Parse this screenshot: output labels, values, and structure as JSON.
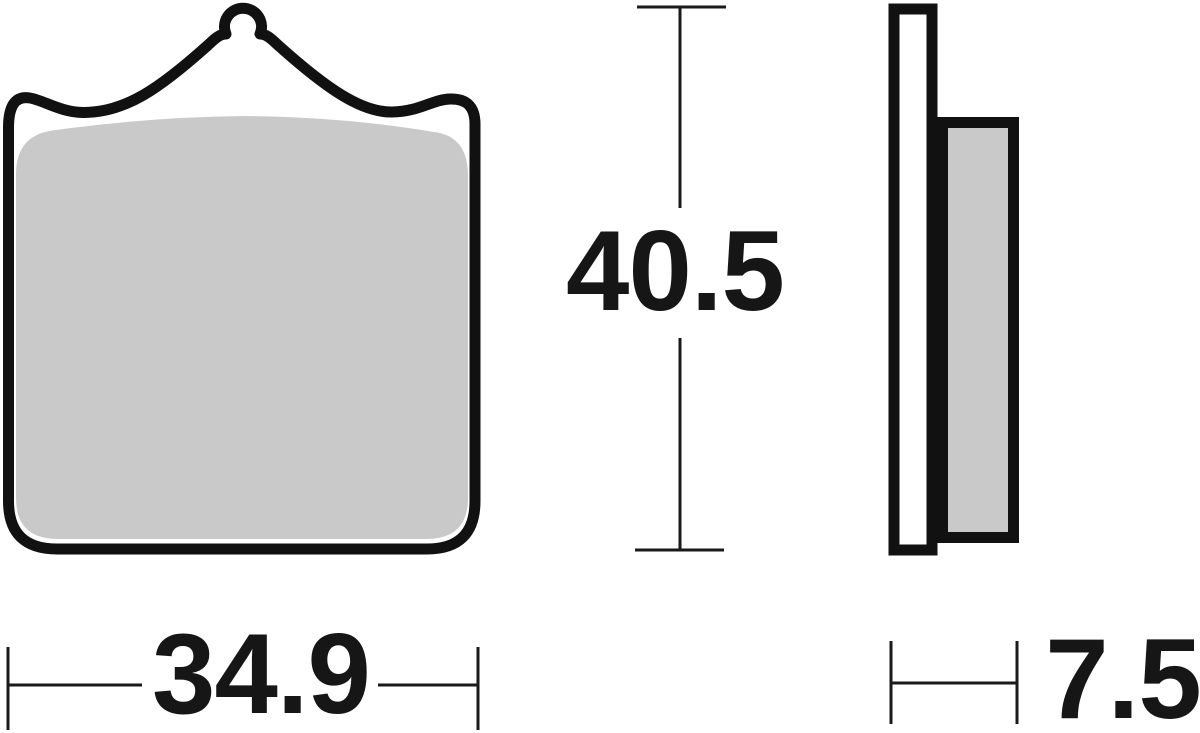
{
  "figure": {
    "type": "technical-drawing",
    "views": {
      "front": "brake-pad-front-profile",
      "side": "brake-pad-side-profile"
    },
    "dimensions": {
      "height": "40.5",
      "width": "34.9",
      "thickness": "7.5"
    },
    "colors": {
      "outline": "#111111",
      "friction_material": "#c9c9c9",
      "backplate_fill": "#ffffff",
      "dimension_lines": "#1a1a1a",
      "label_text": "#161616",
      "background": "#ffffff"
    }
  }
}
